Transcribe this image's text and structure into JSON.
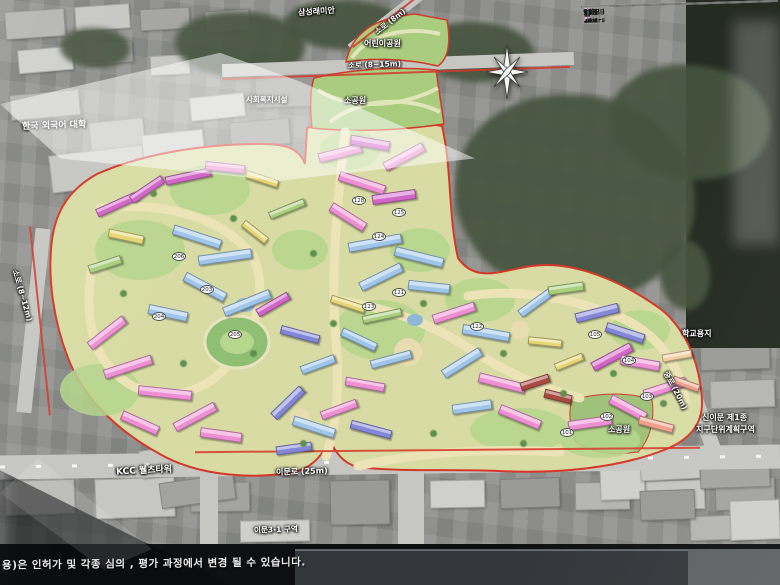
{
  "disclaimer": "용)은 인허가 및 각종 심의 , 평가 과정에서 변경 될 수 있습니다.",
  "map_labels": {
    "samsung_raemian": "삼성래미안",
    "soro_8m": "소로 (8m)",
    "children_park": "어린이공원",
    "soro_8_15m": "소로 (8~15m)",
    "social_welfare": "사회복지시설",
    "small_park_top": "소공원",
    "university": "한국 외국어 대학",
    "soro_8_12m": "소로 (8~12m)",
    "school_site": "학교용지",
    "jungro_20m": "중로 (20m)",
    "sinimun_district_line1": "신이문 제1종",
    "sinimun_district_line2": "지구단위계획구역",
    "small_park_right": "소공원",
    "kcc_tower": "KCC 웰츠타워",
    "imun_ro": "이문로 (25m)",
    "imun_3_1": "이문3-1 구역"
  },
  "table": {
    "header_partial": {
      "label": "구분",
      "value": "188"
    },
    "rows": [
      {
        "cells": [
          {
            "t": "114형",
            "c": "lab"
          },
          {
            "swatch": "#d8e7ae"
          },
          {
            "t": "54 세대",
            "c": "num"
          },
          {
            "t": "",
            "c": "num"
          },
          {
            "t": "54 세대",
            "c": "num"
          }
        ]
      },
      {
        "cells": [
          {
            "t": "99형",
            "c": "lab"
          },
          {
            "swatch": "#eadf7e"
          },
          {
            "t": "",
            "c": "num"
          },
          {
            "t": "54 세대",
            "c": "num"
          },
          {
            "t": "54 세대",
            "c": "num"
          }
        ]
      },
      {
        "cells": [
          {
            "t": "84형",
            "c": "lab"
          },
          {
            "swatch": "#a9cdea"
          },
          {
            "t": "223 세대",
            "c": "num"
          },
          {
            "t": "639 세대",
            "c": "num"
          },
          {
            "t": "862 세대",
            "c": "num"
          }
        ]
      },
      {
        "cells": [
          {
            "t": "74형",
            "c": "lab",
            "rs": 2
          },
          {
            "t": "부분임대",
            "c": "sub",
            "bg": "#e07fd0"
          },
          {
            "t": "",
            "c": "num"
          },
          {
            "t": "139 세대",
            "c": "num"
          },
          {
            "t": "323 세대",
            "c": "num",
            "rs": 2
          }
        ]
      },
      {
        "cells": [
          {
            "t": "일반형",
            "c": "sub",
            "bg": "#eda6da"
          },
          {
            "t": "184 세대",
            "c": "num"
          },
          {
            "t": "",
            "c": "num"
          }
        ]
      },
      {
        "cells": [
          {
            "t": "59형",
            "c": "lab"
          },
          {
            "swatch": "#f190d7"
          },
          {
            "t": "819 세대",
            "c": "num"
          },
          {
            "t": "161 세대",
            "c": "num"
          },
          {
            "t": "980 세대",
            "c": "num"
          }
        ]
      },
      {
        "cells": [
          {
            "t": "55형",
            "c": "lab"
          },
          {
            "swatch": "#f8dcee"
          },
          {
            "t": "205 세대",
            "c": "num"
          },
          {
            "t": "",
            "c": "num"
          },
          {
            "t": "205 세대",
            "c": "num"
          }
        ]
      },
      {
        "cells": [
          {
            "t": "52형",
            "c": "lab"
          },
          {
            "swatch": "#7d80d6"
          },
          {
            "t": "50 세대",
            "c": "num"
          },
          {
            "t": "",
            "c": "num"
          },
          {
            "t": "50 세대",
            "c": "num"
          }
        ]
      },
      {
        "cells": [
          {
            "t": "분양소계",
            "c": "tot",
            "cs": 2
          },
          {
            "t": "1,535 세대",
            "c": "num"
          },
          {
            "t": "993 세대",
            "c": "num"
          },
          {
            "t": "2,528 세대",
            "c": "num"
          }
        ]
      },
      {
        "cells": [
          {
            "t": "52형",
            "c": "lab"
          },
          {
            "swatch": "#ab4a41"
          },
          {
            "t": "56 세대",
            "c": "num"
          },
          {
            "t": "",
            "c": "num"
          },
          {
            "t": "56 세대",
            "c": "num"
          }
        ]
      },
      {
        "cells": [
          {
            "t": "44형",
            "c": "lab"
          },
          {
            "swatch": "#f0a189"
          },
          {
            "t": "249 세대",
            "c": "num"
          },
          {
            "t": "",
            "c": "num"
          },
          {
            "t": "249 세대",
            "c": "num"
          }
        ]
      },
      {
        "cells": [
          {
            "t": "34형",
            "c": "lab"
          },
          {
            "swatch": "#f4d0a3"
          },
          {
            "t": "236 세대",
            "c": "num"
          },
          {
            "t": "",
            "c": "num"
          },
          {
            "t": "236 세대",
            "c": "num"
          }
        ]
      },
      {
        "cells": [
          {
            "t": "임대소계",
            "c": "tot",
            "cs": 2
          },
          {
            "t": "541 세대",
            "c": "num"
          },
          {
            "t": "",
            "c": "num"
          },
          {
            "t": "541 세대",
            "c": "num"
          }
        ]
      },
      {
        "cells": [
          {
            "t": "합  계",
            "c": "tot",
            "cs": 2
          },
          {
            "t": "2,076 세대",
            "c": "num"
          },
          {
            "t": "993 세대",
            "c": "num"
          },
          {
            "t": "3,069 세대",
            "c": "num"
          }
        ]
      }
    ]
  },
  "building_badges": [
    {
      "label": "206",
      "x": 172,
      "y": 252
    },
    {
      "label": "203",
      "x": 200,
      "y": 285
    },
    {
      "label": "204",
      "x": 152,
      "y": 312
    },
    {
      "label": "205",
      "x": 228,
      "y": 330
    },
    {
      "label": "128",
      "x": 352,
      "y": 196
    },
    {
      "label": "125",
      "x": 392,
      "y": 208
    },
    {
      "label": "124",
      "x": 372,
      "y": 232
    },
    {
      "label": "121",
      "x": 392,
      "y": 288
    },
    {
      "label": "123",
      "x": 362,
      "y": 302
    },
    {
      "label": "122",
      "x": 470,
      "y": 322
    },
    {
      "label": "105",
      "x": 588,
      "y": 330
    },
    {
      "label": "104",
      "x": 622,
      "y": 356
    },
    {
      "label": "103",
      "x": 640,
      "y": 392
    },
    {
      "label": "102",
      "x": 600,
      "y": 412
    },
    {
      "label": "101",
      "x": 560,
      "y": 428
    }
  ],
  "colors": {
    "boundary_red": "#d5382a",
    "site_base": "#d8dca4",
    "park_green": "#a9cc7e",
    "type_114": "#d8e7ae",
    "type_99": "#eadf7e",
    "type_84": "#a9cdea",
    "type_74_partial": "#e07fd0",
    "type_74_general": "#eda6da",
    "type_59": "#f190d7",
    "type_55": "#f8dcee",
    "type_52": "#7d80d6",
    "rent_52": "#ab4a41",
    "rent_44": "#f0a189",
    "rent_34": "#f4d0a3"
  }
}
